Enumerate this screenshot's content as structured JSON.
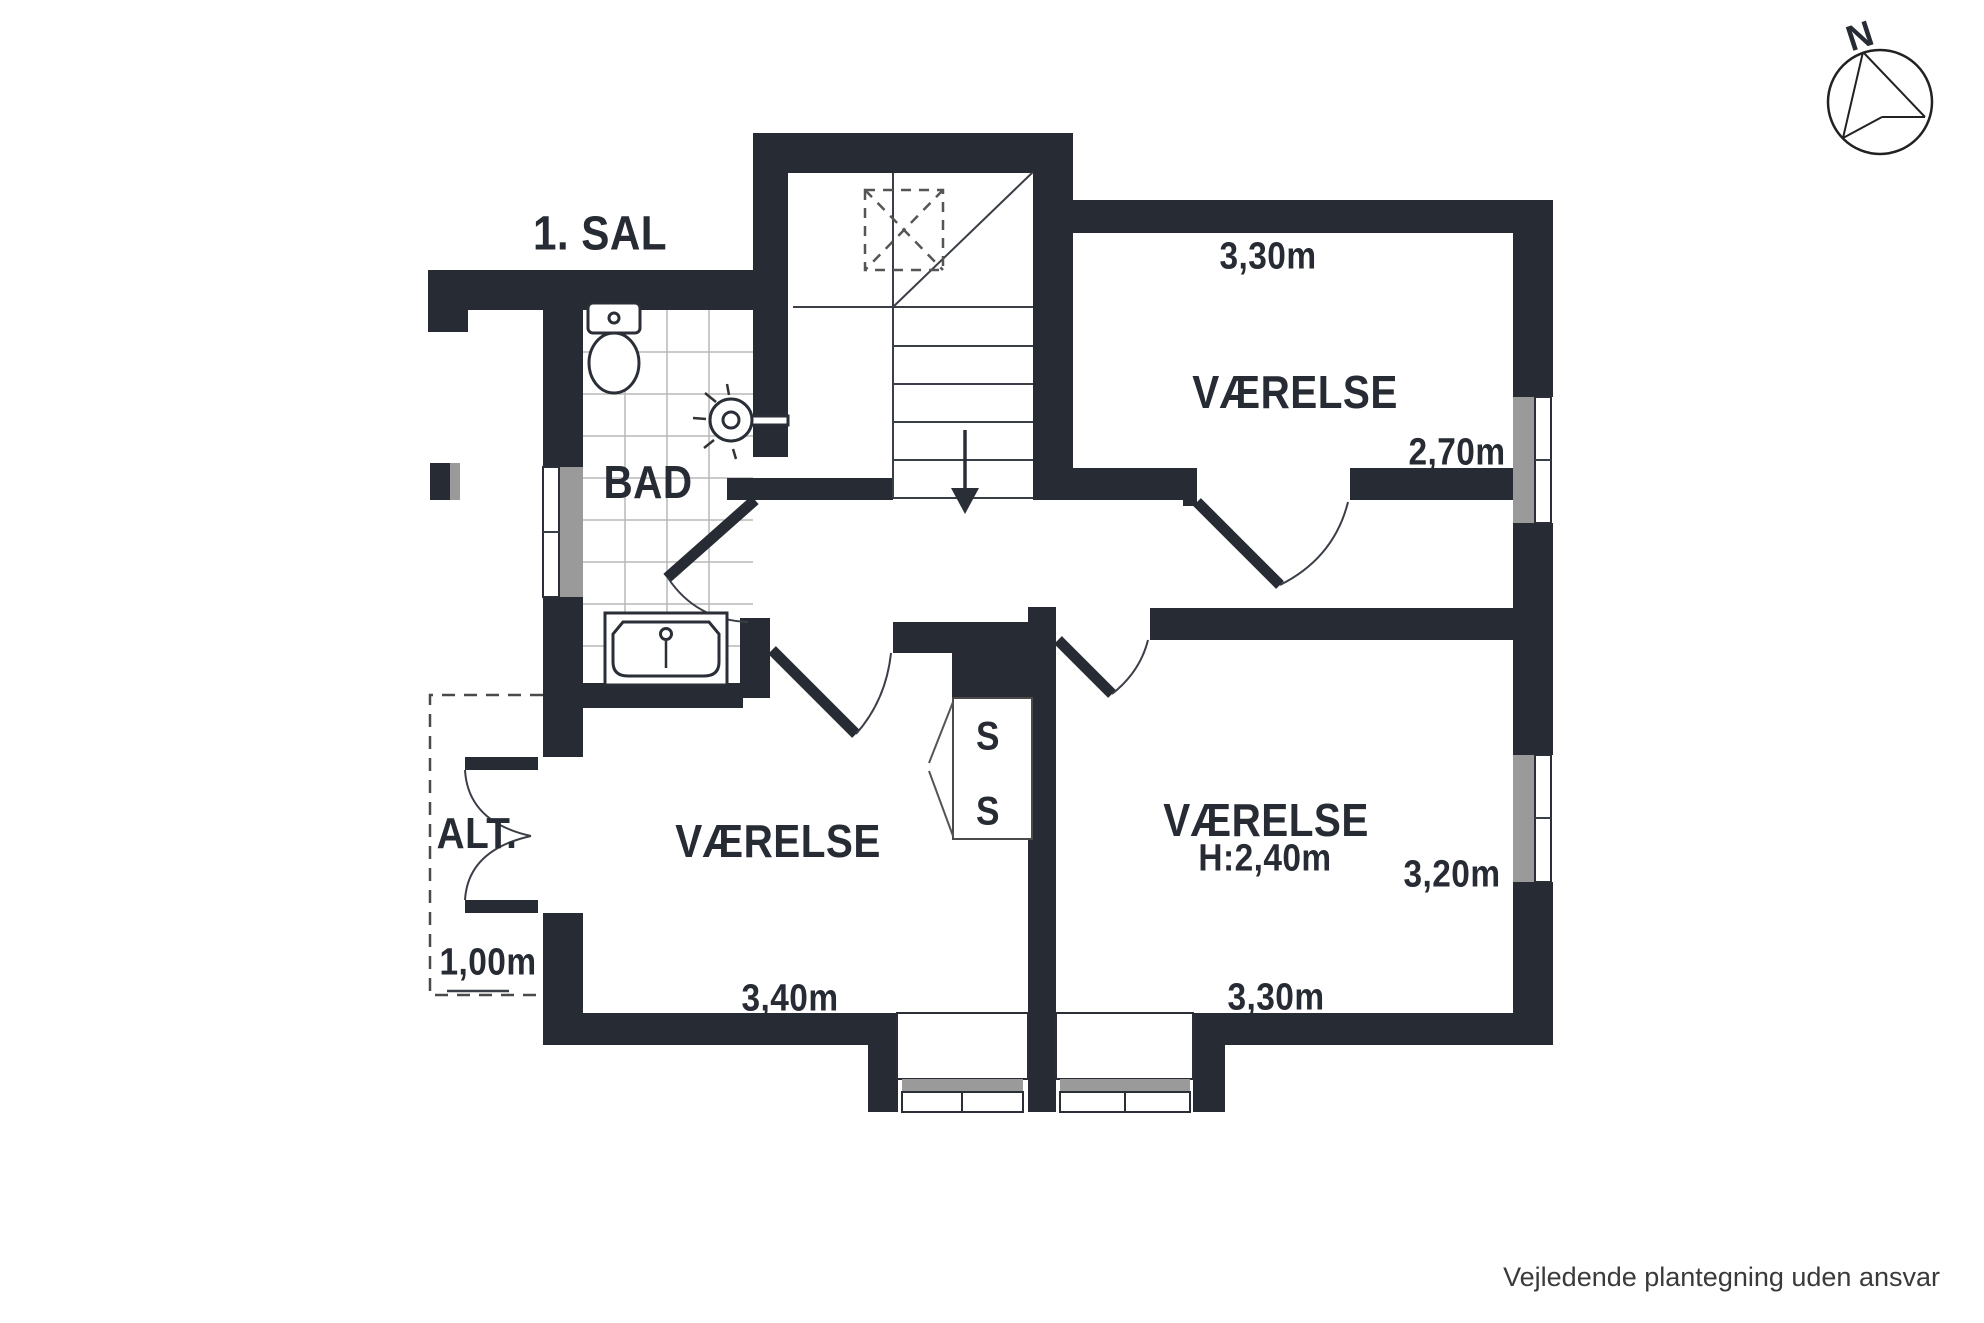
{
  "title": "1. SAL",
  "compass": {
    "label": "N"
  },
  "footer": {
    "disclaimer": "Vejledende plantegning uden ansvar"
  },
  "rooms": {
    "bathroom": {
      "name": "BAD"
    },
    "room_top_right": {
      "name": "VÆRELSE",
      "width": "3,30m",
      "depth": "2,70m"
    },
    "room_bottom_right": {
      "name": "VÆRELSE",
      "ceiling_height": "H:2,40m",
      "depth": "3,20m",
      "width": "3,30m"
    },
    "room_bottom_left": {
      "name": "VÆRELSE",
      "width": "3,40m"
    },
    "balcony": {
      "name": "ALT.",
      "width": "1,00m"
    },
    "closet": {
      "shelf_top": "S",
      "shelf_bottom": "S"
    }
  },
  "colors": {
    "wall": "#272b33",
    "window": "#9a9a9a",
    "tile_line": "#b8b8b8"
  }
}
